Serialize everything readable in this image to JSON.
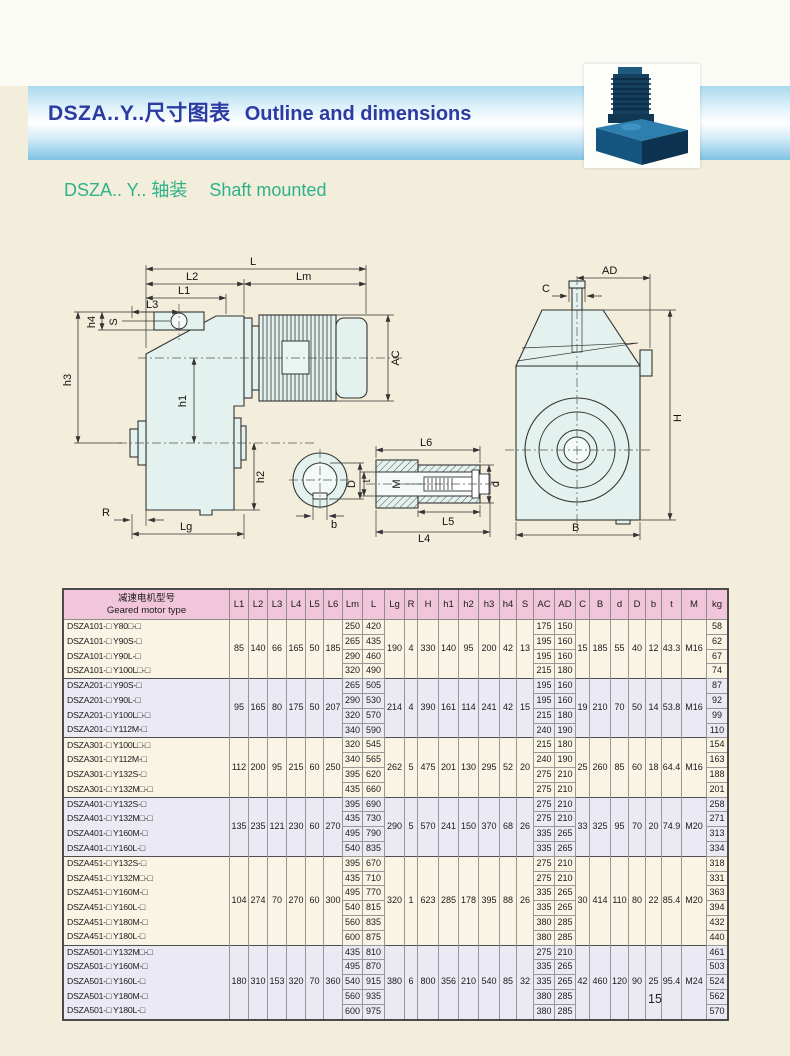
{
  "page": {
    "page_number": "15"
  },
  "header": {
    "title_zh": "DSZA..Y..尺寸图表",
    "title_en": "Outline and dimensions"
  },
  "subtitle": {
    "zh": "DSZA.. Y.. 轴装",
    "en": "Shaft mounted"
  },
  "drawing": {
    "labels": {
      "L": "L",
      "Lm": "Lm",
      "L1": "L1",
      "L2": "L2",
      "L3": "L3",
      "L4": "L4",
      "L5": "L5",
      "L6": "L6",
      "h1": "h1",
      "h2": "h2",
      "h3": "h3",
      "h4": "h4",
      "S": "S",
      "R": "R",
      "Lg": "Lg",
      "AC": "AC",
      "AD": "AD",
      "C": "C",
      "H": "H",
      "B": "B",
      "D": "D",
      "d": "d",
      "M": "M",
      "b": "b",
      "t": "t"
    }
  },
  "table": {
    "header": {
      "model_zh": "减速电机型号",
      "model_en": "Geared motor type"
    },
    "columns": [
      "L1",
      "L2",
      "L3",
      "L4",
      "L5",
      "L6",
      "Lm",
      "L",
      "Lg",
      "R",
      "H",
      "h1",
      "h2",
      "h3",
      "h4",
      "S",
      "AC",
      "AD",
      "C",
      "B",
      "d",
      "D",
      "b",
      "t",
      "M",
      "kg"
    ],
    "groups": [
      {
        "stripe": "cream",
        "shared": {
          "L1": 85,
          "L2": 140,
          "L3": 66,
          "L4": 165,
          "L5": 50,
          "L6": 185,
          "Lg": 190,
          "R": 4,
          "H": 330,
          "h1": 140,
          "h2": 95,
          "h3": 200,
          "h4": 42,
          "S": 13,
          "C": 15,
          "B": 185,
          "d": 55,
          "D": 40,
          "b": 12,
          "t": 43.3,
          "M": "M16"
        },
        "rows": [
          {
            "model": "DSZA101-□ Y80□-□",
            "Lm": 250,
            "L": 420,
            "AC": 175,
            "AD": 150,
            "kg": 58
          },
          {
            "model": "DSZA101-□ Y90S-□",
            "Lm": 265,
            "L": 435,
            "AC": 195,
            "AD": 160,
            "kg": 62
          },
          {
            "model": "DSZA101-□ Y90L-□",
            "Lm": 290,
            "L": 460,
            "AC": 195,
            "AD": 160,
            "kg": 67
          },
          {
            "model": "DSZA101-□ Y100L□-□",
            "Lm": 320,
            "L": 490,
            "AC": 215,
            "AD": 180,
            "kg": 74
          }
        ]
      },
      {
        "stripe": "lav",
        "shared": {
          "L1": 95,
          "L2": 165,
          "L3": 80,
          "L4": 175,
          "L5": 50,
          "L6": 207,
          "Lg": 214,
          "R": 4,
          "H": 390,
          "h1": 161,
          "h2": 114,
          "h3": 241,
          "h4": 42,
          "S": 15,
          "C": 19,
          "B": 210,
          "d": 70,
          "D": 50,
          "b": 14,
          "t": 53.8,
          "M": "M16"
        },
        "rows": [
          {
            "model": "DSZA201-□ Y90S-□",
            "Lm": 265,
            "L": 505,
            "AC": 195,
            "AD": 160,
            "kg": 87
          },
          {
            "model": "DSZA201-□ Y90L-□",
            "Lm": 290,
            "L": 530,
            "AC": 195,
            "AD": 160,
            "kg": 92
          },
          {
            "model": "DSZA201-□ Y100L□-□",
            "Lm": 320,
            "L": 570,
            "AC": 215,
            "AD": 180,
            "kg": 99
          },
          {
            "model": "DSZA201-□ Y112M-□",
            "Lm": 340,
            "L": 590,
            "AC": 240,
            "AD": 190,
            "kg": 110
          }
        ]
      },
      {
        "stripe": "cream",
        "shared": {
          "L1": 112,
          "L2": 200,
          "L3": 95,
          "L4": 215,
          "L5": 60,
          "L6": 250,
          "Lg": 262,
          "R": 5,
          "H": 475,
          "h1": 201,
          "h2": 130,
          "h3": 295,
          "h4": 52,
          "S": 20,
          "C": 25,
          "B": 260,
          "d": 85,
          "D": 60,
          "b": 18,
          "t": 64.4,
          "M": "M16"
        },
        "rows": [
          {
            "model": "DSZA301-□ Y100L□-□",
            "Lm": 320,
            "L": 545,
            "AC": 215,
            "AD": 180,
            "kg": 154
          },
          {
            "model": "DSZA301-□ Y112M-□",
            "Lm": 340,
            "L": 565,
            "AC": 240,
            "AD": 190,
            "kg": 163
          },
          {
            "model": "DSZA301-□ Y132S-□",
            "Lm": 395,
            "L": 620,
            "AC": 275,
            "AD": 210,
            "kg": 188
          },
          {
            "model": "DSZA301-□ Y132M□-□",
            "Lm": 435,
            "L": 660,
            "AC": 275,
            "AD": 210,
            "kg": 201
          }
        ]
      },
      {
        "stripe": "lav",
        "shared": {
          "L1": 135,
          "L2": 235,
          "L3": 121,
          "L4": 230,
          "L5": 60,
          "L6": 270,
          "Lg": 290,
          "R": 5,
          "H": 570,
          "h1": 241,
          "h2": 150,
          "h3": 370,
          "h4": 68,
          "S": 26,
          "C": 33,
          "B": 325,
          "d": 95,
          "D": 70,
          "b": 20,
          "t": 74.9,
          "M": "M20"
        },
        "rows": [
          {
            "model": "DSZA401-□ Y132S-□",
            "Lm": 395,
            "L": 690,
            "AC": 275,
            "AD": 210,
            "kg": 258
          },
          {
            "model": "DSZA401-□ Y132M□-□",
            "Lm": 435,
            "L": 730,
            "AC": 275,
            "AD": 210,
            "kg": 271
          },
          {
            "model": "DSZA401-□ Y160M-□",
            "Lm": 495,
            "L": 790,
            "AC": 335,
            "AD": 265,
            "kg": 313
          },
          {
            "model": "DSZA401-□ Y160L-□",
            "Lm": 540,
            "L": 835,
            "AC": 335,
            "AD": 265,
            "kg": 334
          }
        ]
      },
      {
        "stripe": "cream",
        "shared": {
          "L1": 104,
          "L2": 274,
          "L3": 70,
          "L4": 270,
          "L5": 60,
          "L6": 300,
          "Lg": 320,
          "R": 1,
          "H": 623,
          "h1": 285,
          "h2": 178,
          "h3": 395,
          "h4": 88,
          "S": 26,
          "C": 30,
          "B": 414,
          "d": 110,
          "D": 80,
          "b": 22,
          "t": 85.4,
          "M": "M20"
        },
        "rows": [
          {
            "model": "DSZA451-□ Y132S-□",
            "Lm": 395,
            "L": 670,
            "AC": 275,
            "AD": 210,
            "kg": 318
          },
          {
            "model": "DSZA451-□ Y132M□-□",
            "Lm": 435,
            "L": 710,
            "AC": 275,
            "AD": 210,
            "kg": 331
          },
          {
            "model": "DSZA451-□ Y160M-□",
            "Lm": 495,
            "L": 770,
            "AC": 335,
            "AD": 265,
            "kg": 363
          },
          {
            "model": "DSZA451-□ Y160L-□",
            "Lm": 540,
            "L": 815,
            "AC": 335,
            "AD": 265,
            "kg": 394
          },
          {
            "model": "DSZA451-□ Y180M-□",
            "Lm": 560,
            "L": 835,
            "AC": 380,
            "AD": 285,
            "kg": 432
          },
          {
            "model": "DSZA451-□ Y180L-□",
            "Lm": 600,
            "L": 875,
            "AC": 380,
            "AD": 285,
            "kg": 440
          }
        ]
      },
      {
        "stripe": "lav",
        "shared": {
          "L1": 180,
          "L2": 310,
          "L3": 153,
          "L4": 320,
          "L5": 70,
          "L6": 360,
          "Lg": 380,
          "R": 6,
          "H": 800,
          "h1": 356,
          "h2": 210,
          "h3": 540,
          "h4": 85,
          "S": 32,
          "C": 42,
          "B": 460,
          "d": 120,
          "D": 90,
          "b": 25,
          "t": 95.4,
          "M": "M24"
        },
        "rows": [
          {
            "model": "DSZA501-□ Y132M□-□",
            "Lm": 435,
            "L": 810,
            "AC": 275,
            "AD": 210,
            "kg": 461
          },
          {
            "model": "DSZA501-□ Y160M-□",
            "Lm": 495,
            "L": 870,
            "AC": 335,
            "AD": 265,
            "kg": 503
          },
          {
            "model": "DSZA501-□ Y160L-□",
            "Lm": 540,
            "L": 915,
            "AC": 335,
            "AD": 265,
            "kg": 524
          },
          {
            "model": "DSZA501-□ Y180M-□",
            "Lm": 560,
            "L": 935,
            "AC": 380,
            "AD": 285,
            "kg": 562
          },
          {
            "model": "DSZA501-□ Y180L-□",
            "Lm": 600,
            "L": 975,
            "AC": 380,
            "AD": 285,
            "kg": 570
          }
        ]
      }
    ]
  }
}
